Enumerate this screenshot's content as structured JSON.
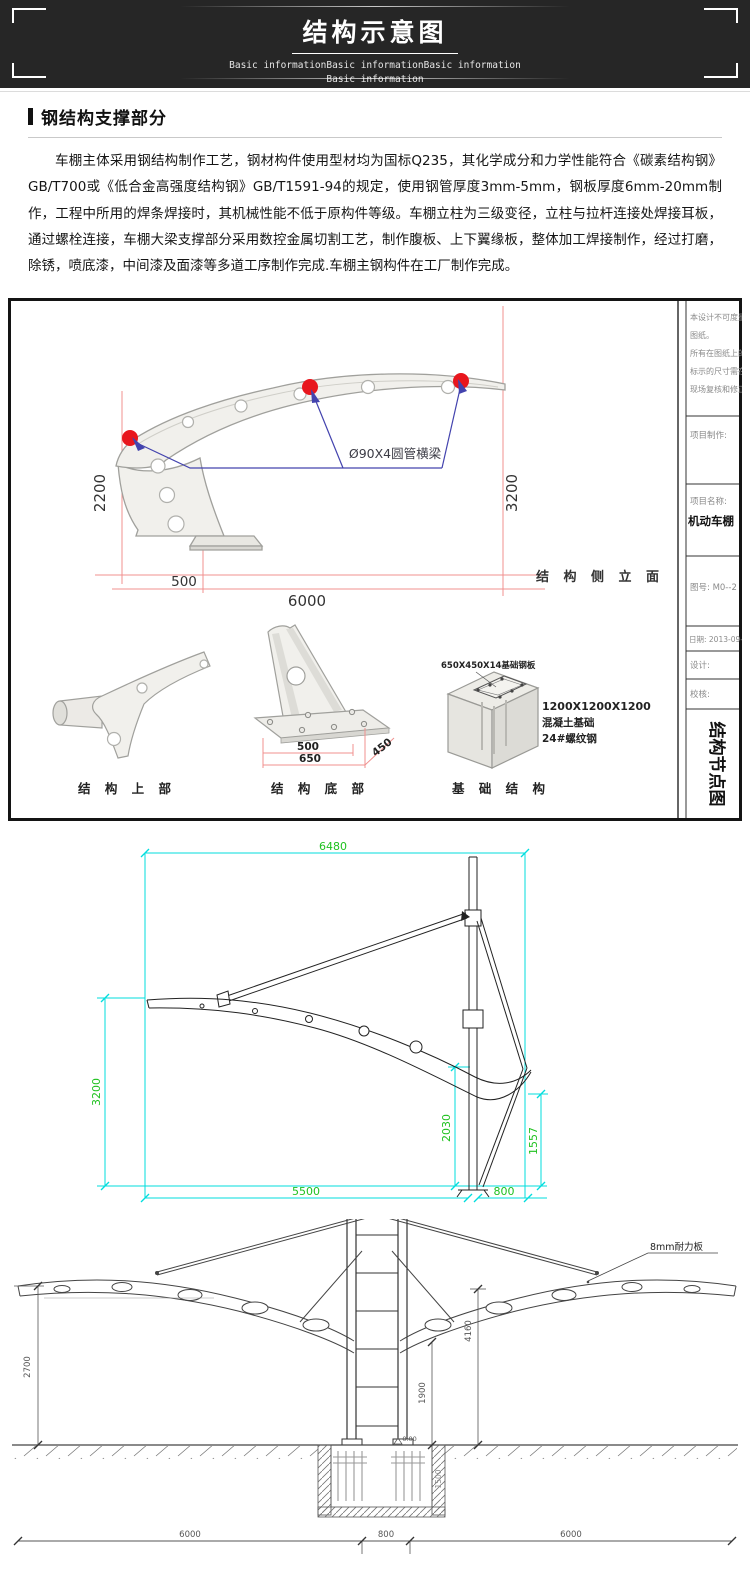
{
  "header": {
    "title": "结构示意图",
    "subtitle1": "Basic informationBasic informationBasic information",
    "subtitle2": "Basic information"
  },
  "section": {
    "title": "钢结构支撑部分",
    "paragraph": "车棚主体采用钢结构制作工艺，钢材构件使用型材均为国标Q235，其化学成分和力学性能符合《碳素结构钢》GB/T700或《低合金高强度结构钢》GB/T1591-94的规定，使用钢管厚度3mm-5mm，钢板厚度6mm-20mm制作，工程中所用的焊条焊接时，其机械性能不低于原构件等级。车棚立柱为三级变径，立柱与拉杆连接处焊接耳板，通过螺栓连接，车棚大梁支撑部分采用数控金属切割工艺，制作腹板、上下翼缘板，整体加工焊接制作，经过打磨，除锈，喷底漆，中间漆及面漆等多道工序制作完成.车棚主钢构件在工厂制作完成。"
  },
  "elevation": {
    "dim_left": "2200",
    "dim_right": "3200",
    "dim_base": "500",
    "dim_span": "6000",
    "beam_label": "Ø90X4圆管横梁",
    "view_label": "结 构 侧 立 面"
  },
  "details": {
    "upper_caption": "结 构 上 部",
    "bottom_caption": "结 构 底 部",
    "foundation_caption": "基 础 结 构",
    "dim_500": "500",
    "dim_650": "650",
    "dim_450": "450",
    "plate_label": "650X450X14基础钢板",
    "conc1": "1200X1200X1200",
    "conc2": "混凝土基础",
    "conc3": "24#螺纹钢"
  },
  "titleblock": {
    "note1": "本设计不可度量",
    "note2": "图纸。",
    "note3": "所有在图纸上的",
    "note4": "标示的尺寸需在",
    "note5": "现场复核和修正。",
    "maker": "项目制作:",
    "name_label": "项目名称:",
    "project": "机动车棚",
    "drawing_no": "图号: M0--2",
    "date": "日期: 2013-09-30",
    "designer": "设计:",
    "checker": "校核:",
    "sheet": "结构节点图"
  },
  "cad": {
    "d6480": "6480",
    "d3200": "3200",
    "d2030": "2030",
    "d1557": "1557",
    "d5500": "5500",
    "d800": "800"
  },
  "front": {
    "d2700": "2700",
    "d4160": "4160",
    "d1900": "1900",
    "d1500": "1500",
    "d6000a": "6000",
    "d800": "800",
    "d6000b": "6000",
    "panel_label": "8mm耐力板",
    "level": "-0.00"
  },
  "colors": {
    "accent_red": "#e8161d",
    "dim_pink": "#f0918f",
    "leader_blue": "#4343ae",
    "cad_cyan": "#00dede",
    "cad_green": "#1fc11f"
  }
}
